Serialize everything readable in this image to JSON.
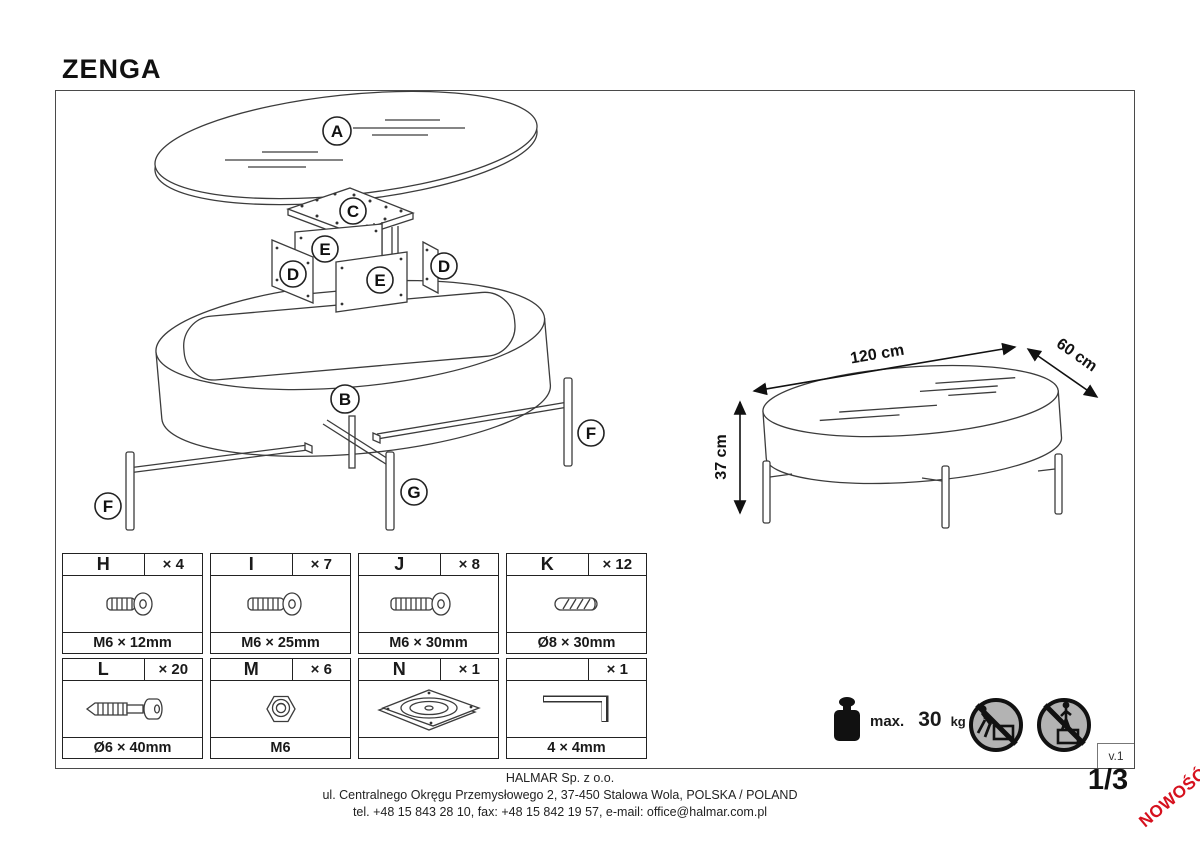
{
  "page": {
    "title": "ZENGA",
    "version": "v.1",
    "page_number": "1/3",
    "new_badge": "NOWOŚĆ"
  },
  "parts": {
    "a": "A",
    "b": "B",
    "c": "C",
    "d": "D",
    "e": "E",
    "f": "F",
    "g": "G"
  },
  "dimensions": {
    "length": "120 cm",
    "depth": "60 cm",
    "height": "37 cm"
  },
  "load_limit": {
    "label": "max.",
    "value": "30",
    "unit": "kg"
  },
  "hardware": {
    "cells": [
      {
        "letter": "H",
        "count": "× 4",
        "caption": "M6 × 12mm",
        "icon": "machine-screw-short-icon"
      },
      {
        "letter": "I",
        "count": "× 7",
        "caption": "M6 × 25mm",
        "icon": "machine-screw-medium-icon"
      },
      {
        "letter": "J",
        "count": "× 8",
        "caption": "M6 × 30mm",
        "icon": "machine-screw-long-icon"
      },
      {
        "letter": "K",
        "count": "× 12",
        "caption": "Ø8 × 30mm",
        "icon": "wooden-dowel-icon"
      },
      {
        "letter": "L",
        "count": "× 20",
        "caption": "Ø6 × 40mm",
        "icon": "confirmat-screw-icon"
      },
      {
        "letter": "M",
        "count": "× 6",
        "caption": "M6",
        "icon": "hex-nut-icon"
      },
      {
        "letter": "N",
        "count": "× 1",
        "caption": "",
        "icon": "swivel-plate-icon"
      },
      {
        "letter": "",
        "count": "× 1",
        "caption": "4 × 4mm",
        "icon": "allen-key-icon"
      }
    ]
  },
  "safety": {
    "icons": [
      "no-pushing-icon",
      "no-standing-icon"
    ]
  },
  "footer": {
    "company": "HALMAR Sp. z o.o.",
    "address": "ul. Centralnego Okręgu Przemysłowego 2, 37-450 Stalowa Wola, POLSKA / POLAND",
    "contact": "tel. +48 15 843 28 10, fax: +48 15 842 19 57, e-mail: office@halmar.com.pl"
  },
  "colors": {
    "badge_red": "#d6111e",
    "line": "#3c3c3c",
    "prohibition_gray": "#b3b3b3"
  }
}
